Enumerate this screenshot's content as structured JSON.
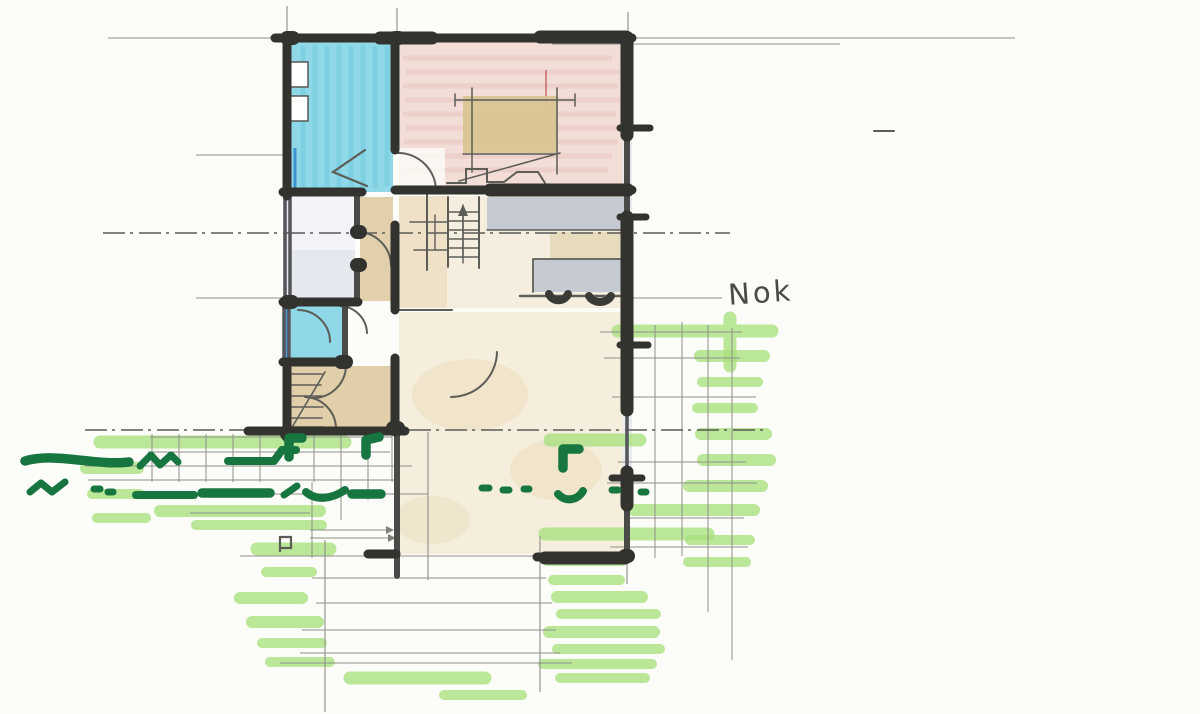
{
  "annotations": {
    "nok_label": "Nok"
  },
  "palette": {
    "paper": "#fcfcf9",
    "wall": "#32322e",
    "pencil": "#5d5d58",
    "pencil_light": "#8f8f89",
    "cyan": "#8ed8e7",
    "cyan_streak": "#55bcd6",
    "blue_line": "#2f86c8",
    "pink": "#f3ddd7",
    "pink_streak": "#dfb4ab",
    "red_streak": "#b4453c",
    "tan": "#dcc89d",
    "beige": "#ecdcbc",
    "bed_tan": "#d8c391",
    "grey": "#c6cad2",
    "window": "#e9ebf3",
    "marker_light_green": "#a8e07e",
    "marker_dark_green": "#17763f",
    "ink": "#4a4a46"
  }
}
